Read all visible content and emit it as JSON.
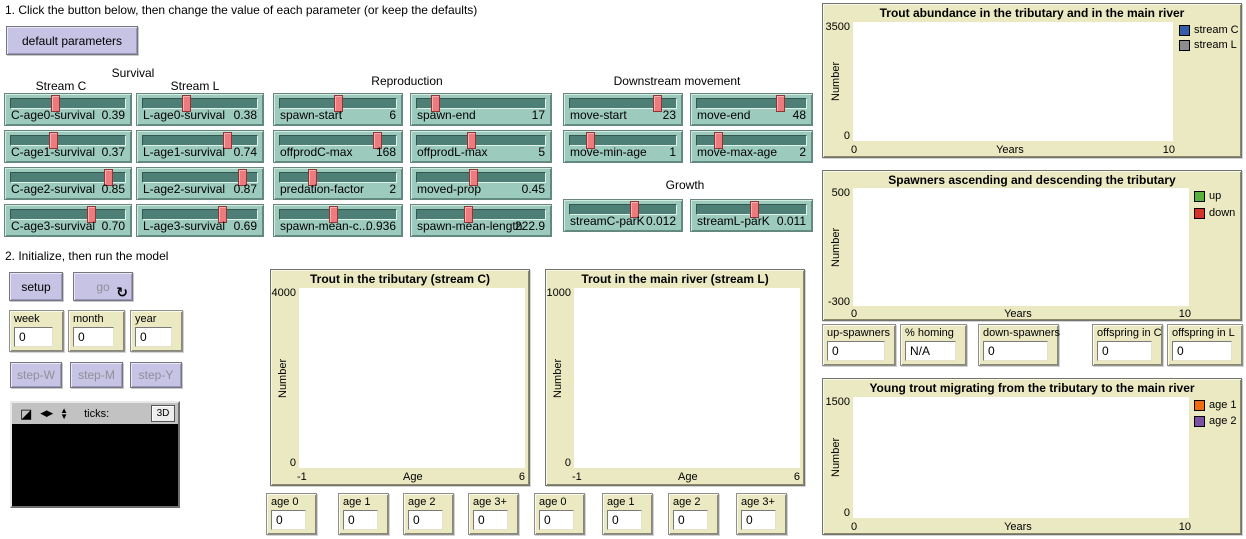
{
  "instructions": {
    "step1": "1. Click the button below, then change the value of each parameter (or keep the defaults)",
    "step2": "2. Initialize, then run the model"
  },
  "buttons": {
    "default_parameters": "default parameters",
    "setup": "setup",
    "go": "go",
    "go_icon": "↻",
    "step_w": "step-W",
    "step_m": "step-M",
    "step_y": "step-Y"
  },
  "group_labels": {
    "survival": "Survival",
    "stream_c": "Stream C",
    "stream_l": "Stream L",
    "reproduction": "Reproduction",
    "downstream_movement": "Downstream movement",
    "growth": "Growth"
  },
  "sliders": {
    "c_age0": {
      "label": "C-age0-survival",
      "value": "0.39",
      "pct": 39
    },
    "l_age0": {
      "label": "L-age0-survival",
      "value": "0.38",
      "pct": 38
    },
    "c_age1": {
      "label": "C-age1-survival",
      "value": "0.37",
      "pct": 37
    },
    "l_age1": {
      "label": "L-age1-survival",
      "value": "0.74",
      "pct": 74
    },
    "c_age2": {
      "label": "C-age2-survival",
      "value": "0.85",
      "pct": 85
    },
    "l_age2": {
      "label": "L-age2-survival",
      "value": "0.87",
      "pct": 87
    },
    "c_age3": {
      "label": "C-age3-survival",
      "value": "0.70",
      "pct": 70
    },
    "l_age3": {
      "label": "L-age3-survival",
      "value": "0.69",
      "pct": 69
    },
    "spawn_start": {
      "label": "spawn-start",
      "value": "6",
      "pct": 50
    },
    "spawn_end": {
      "label": "spawn-end",
      "value": "17",
      "pct": 14
    },
    "offprodc_max": {
      "label": "offprodC-max",
      "value": "168",
      "pct": 84
    },
    "offprodl_max": {
      "label": "offprodL-max",
      "value": "5",
      "pct": 42
    },
    "predation_factor": {
      "label": "predation-factor",
      "value": "2",
      "pct": 28
    },
    "moved_prop": {
      "label": "moved-prop",
      "value": "0.45",
      "pct": 44
    },
    "spawn_mean_c": {
      "label": "spawn-mean-c...",
      "value": "0.936",
      "pct": 46
    },
    "spawn_mean_length": {
      "label": "spawn-mean-length",
      "value": "222.9",
      "pct": 40
    },
    "move_start": {
      "label": "move-start",
      "value": "23",
      "pct": 82
    },
    "move_end": {
      "label": "move-end",
      "value": "48",
      "pct": 76
    },
    "move_min_age": {
      "label": "move-min-age",
      "value": "1",
      "pct": 19
    },
    "move_max_age": {
      "label": "move-max-age",
      "value": "2",
      "pct": 19
    },
    "streamc_park": {
      "label": "streamC-parK",
      "value": "0.012",
      "pct": 60
    },
    "streaml_park": {
      "label": "streamL-parK",
      "value": "0.011",
      "pct": 52
    }
  },
  "counters": {
    "week": {
      "label": "week",
      "value": "0"
    },
    "month": {
      "label": "month",
      "value": "0"
    },
    "year": {
      "label": "year",
      "value": "0"
    }
  },
  "view": {
    "ticks_label": "ticks:",
    "threed_label": "3D",
    "icons": {
      "resize": "◪",
      "horiz": "◀▶",
      "vert_up": "▲",
      "vert_down": "▼"
    }
  },
  "age_monitors": {
    "c": [
      {
        "label": "age 0",
        "value": "0"
      },
      {
        "label": "age 1",
        "value": "0"
      },
      {
        "label": "age 2",
        "value": "0"
      },
      {
        "label": "age 3+",
        "value": "0"
      }
    ],
    "l": [
      {
        "label": "age 0",
        "value": "0"
      },
      {
        "label": "age 1",
        "value": "0"
      },
      {
        "label": "age 2",
        "value": "0"
      },
      {
        "label": "age 3+",
        "value": "0"
      }
    ]
  },
  "spawn_monitors": [
    {
      "label": "up-spawners",
      "value": "0"
    },
    {
      "label": "% homing",
      "value": "N/A"
    },
    {
      "label": "down-spawners",
      "value": "0"
    },
    {
      "label": "offspring in C",
      "value": "0"
    },
    {
      "label": "offspring in L",
      "value": "0"
    }
  ],
  "plots": {
    "tributary": {
      "title": "Trout in the tributary (stream C)",
      "ylabel": "Number",
      "xlabel": "Age",
      "ymax": "4000",
      "ymin": "0",
      "xmin": "-1",
      "xmax": "6"
    },
    "main_river": {
      "title": "Trout in the main river (stream L)",
      "ylabel": "Number",
      "xlabel": "Age",
      "ymax": "1000",
      "ymin": "0",
      "xmin": "-1",
      "xmax": "6"
    },
    "abundance": {
      "title": "Trout abundance in the tributary and in the main river",
      "ylabel": "Number",
      "xlabel": "Years",
      "ymax": "3500",
      "ymin": "0",
      "xmin": "0",
      "xmax": "10",
      "legend": [
        {
          "label": "stream C",
          "color": "#345da9"
        },
        {
          "label": "stream L",
          "color": "#8d8d8d"
        }
      ]
    },
    "spawners": {
      "title": "Spawners ascending and descending the tributary",
      "ylabel": "Number",
      "xlabel": "Years",
      "ymax": "500",
      "ymin": "-300",
      "xmin": "0",
      "xmax": "10",
      "legend": [
        {
          "label": "up",
          "color": "#59b03c"
        },
        {
          "label": "down",
          "color": "#d73229"
        }
      ]
    },
    "migrating": {
      "title": "Young trout migrating from the tributary to the main river",
      "ylabel": "Number",
      "xlabel": "Years",
      "ymax": "1500",
      "ymin": "0",
      "xmin": "0",
      "xmax": "10",
      "legend": [
        {
          "label": "age 1",
          "color": "#f16a0e"
        },
        {
          "label": "age 2",
          "color": "#7c50a4"
        }
      ]
    }
  },
  "chart_data": [
    {
      "type": "line",
      "title": "Trout in the tributary (stream C)",
      "xlabel": "Age",
      "ylabel": "Number",
      "xlim": [
        -1,
        6
      ],
      "ylim": [
        0,
        4000
      ],
      "grid": false,
      "series": []
    },
    {
      "type": "line",
      "title": "Trout in the main river (stream L)",
      "xlabel": "Age",
      "ylabel": "Number",
      "xlim": [
        -1,
        6
      ],
      "ylim": [
        0,
        1000
      ],
      "grid": false,
      "series": []
    },
    {
      "type": "line",
      "title": "Trout abundance in the tributary and in the main river",
      "xlabel": "Years",
      "ylabel": "Number",
      "xlim": [
        0,
        10
      ],
      "ylim": [
        0,
        3500
      ],
      "grid": false,
      "legend_position": "right",
      "series": [
        {
          "name": "stream C",
          "color": "#345da9",
          "x": [],
          "values": []
        },
        {
          "name": "stream L",
          "color": "#8d8d8d",
          "x": [],
          "values": []
        }
      ]
    },
    {
      "type": "line",
      "title": "Spawners ascending and descending the tributary",
      "xlabel": "Years",
      "ylabel": "Number",
      "xlim": [
        0,
        10
      ],
      "ylim": [
        -300,
        500
      ],
      "grid": false,
      "legend_position": "right",
      "series": [
        {
          "name": "up",
          "color": "#59b03c",
          "x": [],
          "values": []
        },
        {
          "name": "down",
          "color": "#d73229",
          "x": [],
          "values": []
        }
      ]
    },
    {
      "type": "line",
      "title": "Young trout migrating from the tributary to the main river",
      "xlabel": "Years",
      "ylabel": "Number",
      "xlim": [
        0,
        10
      ],
      "ylim": [
        0,
        1500
      ],
      "grid": false,
      "legend_position": "right",
      "series": [
        {
          "name": "age 1",
          "color": "#f16a0e",
          "x": [],
          "values": []
        },
        {
          "name": "age 2",
          "color": "#7c50a4",
          "x": [],
          "values": []
        }
      ]
    }
  ]
}
